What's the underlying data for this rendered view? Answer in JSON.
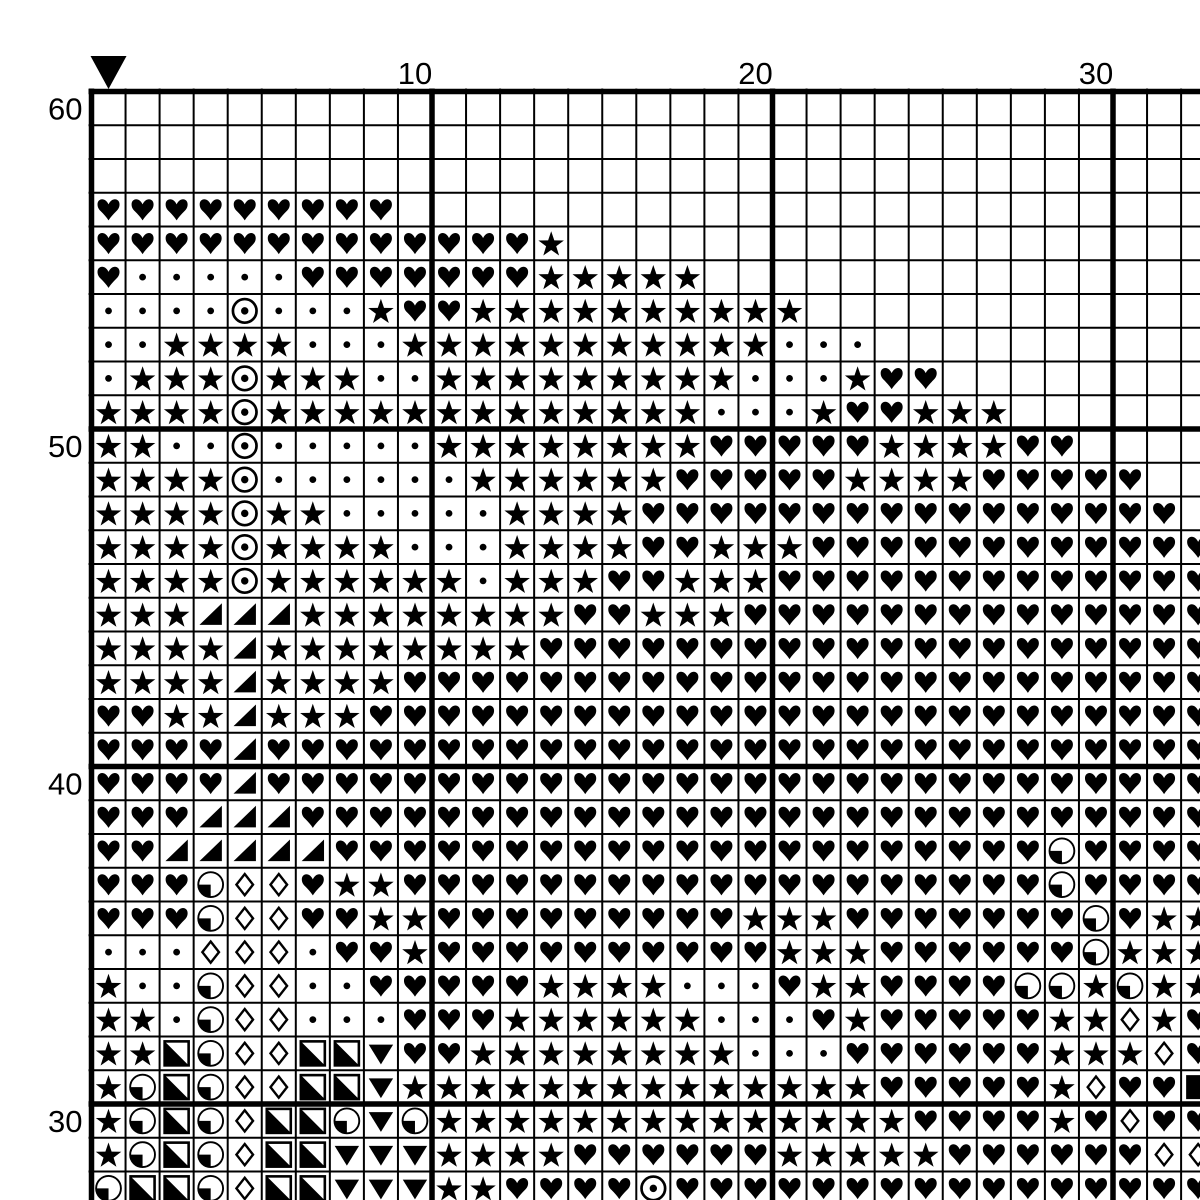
{
  "title": "cross-stitch pattern chart",
  "colors": {
    "ink": "#000000",
    "background": "#ffffff"
  },
  "axis": {
    "top_labels": [
      {
        "text": "10",
        "col": 10
      },
      {
        "text": "20",
        "col": 20
      },
      {
        "text": "30",
        "col": 30
      }
    ],
    "left_labels": [
      {
        "text": "60",
        "row": 60
      },
      {
        "text": "50",
        "row": 50
      },
      {
        "text": "40",
        "row": 40
      },
      {
        "text": "30",
        "row": 30
      }
    ]
  },
  "marker": {
    "col": 1,
    "icon": "center-marker-down-triangle"
  },
  "grid": {
    "first_row": 60,
    "last_row": 28,
    "cols": 33,
    "thick_line_every": 10,
    "symbols_legend": {
      "h": "black-heart",
      "s": "black-star",
      "d": "dot",
      "o": "circled-dot",
      "t": "black-lower-right-triangle",
      "D": "white-diamond",
      "v": "black-down-triangle",
      "q": "circle-lower-left-quadrant-black",
      "Q": "square-lower-left-half-black",
      "B": "black-square",
      ".": "empty"
    },
    "rows_data": [
      ".................................",
      ".................................",
      ".................................",
      "hhhhhhhhh........................",
      "hhhhhhhhhhhhhs...................",
      "hdddddhhhhhhhsssss...............",
      "ddddodddshhssssssssss............",
      "ddssssdddsssssssssssddd..........",
      "dsssosssddsssssssssdddshh........",
      "ssssosssssssssssssdddshhsss......",
      "ssddodddddsssssssshhhhhsssshh....",
      "ssssoddddddsssssshhhhhsssshhhhh..",
      "ssssossdddddsssshhhhhhhhhhhhhhhh.",
      "ssssossssdddsssshhssshhhhhhhhhhhh",
      "ssssossssssdssshhssshhhhhhhhhhhhh",
      "ssstttsssssssshhssshhhhhhhhhhhhhh",
      "sssstsssssssshhhhhhhhhhhhhhhhhhhh",
      "sssstsssshhhhhhhhhhhhhhhhhhhhhhhh",
      "hhsstssshhhhhhhhhhhhhhhhhhhhhhhhh",
      "hhhhthhhhhhhhhhhhhhhhhhhhhhhhhhhh",
      "hhhhthhhhhhhhhhhhhhhhhhhhhhhhhhhh",
      "hhhttthhhhhhhhhhhhhhhhhhhhhhhhhhh",
      "hhttttthhhhhhhhhhhhhhhhhhhhhqhhhh",
      "hhhqDDhsshhhhhhhhhhhhhhhhhhhqhhhh",
      "hhhqDDhhsshhhhhhhhhssshhhhhhhqhss",
      "dddDDDdhhshhhhhhhhhhssshhhhhhqsss",
      "sddqDDddhhhhhssssdddhsshhhhqqsqss",
      "ssdqDDdddhhhssssssdddhshhhhhssDsh",
      "ssQqDDQQvhhssssssssdddhhhhhhsssDh",
      "sqQqDDQQvsssssssssssssshhhhhsDhhB",
      "sqQqDQQqvqsssssssssssssshhhhshDhh",
      "sqQqDQQvvvsssshhhhhhssssshhhhhhDD",
      "qQQqDQQvvvsshhhhohhhhhhhhhhhhhhhh"
    ]
  }
}
